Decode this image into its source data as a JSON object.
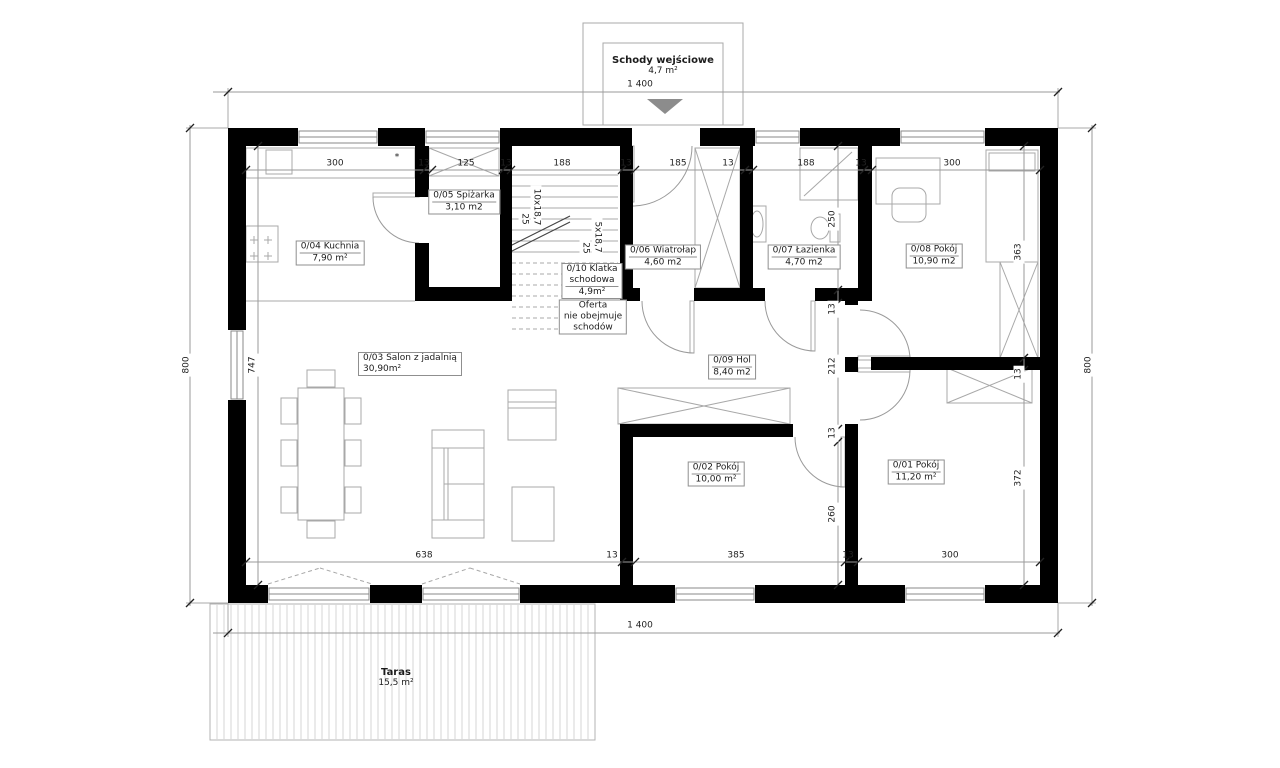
{
  "colors": {
    "wall": "#000000",
    "thin": "#9a9a9a",
    "furniture": "#a8a8a8",
    "door": "#9a9a9a",
    "hatch_line": "#d6d6d6",
    "hatch_border": "#b3b3b3",
    "tick": "#222222",
    "arrow": "#8c8c8c"
  },
  "labels": [
    {
      "n": "entrance-stairs-label",
      "lines": [
        "Schody wejściowe",
        "4,7 m²"
      ],
      "x": 663,
      "y": 66,
      "b": 1
    },
    {
      "n": "room-label-kuchnia",
      "lines": [
        "0/04 Kuchnia",
        "7,90 m²"
      ],
      "x": 330,
      "y": 253,
      "box": 1,
      "sep": 1
    },
    {
      "n": "room-label-spizarka",
      "lines": [
        "0/05 Spiżarka",
        "3,10 m2"
      ],
      "x": 464,
      "y": 202,
      "box": 1,
      "sep": 1
    },
    {
      "n": "room-label-klatka-schodowa",
      "lines": [
        "0/10 Klatka",
        "schodowa",
        "4,9m²"
      ],
      "x": 592,
      "y": 281,
      "box": 1,
      "sep": 1
    },
    {
      "n": "stairs-note",
      "lines": [
        "Oferta",
        "nie obejmuje",
        "schodów"
      ],
      "x": 593,
      "y": 317,
      "box": 1
    },
    {
      "n": "room-label-wiatrolap",
      "lines": [
        "0/06 Wiatrołap",
        "4,60 m2"
      ],
      "x": 663,
      "y": 257,
      "box": 1,
      "sep": 1
    },
    {
      "n": "room-label-lazienka",
      "lines": [
        "0/07 Łazienka",
        "4,70 m2"
      ],
      "x": 804,
      "y": 257,
      "box": 1,
      "sep": 1
    },
    {
      "n": "room-label-pokoj-08",
      "lines": [
        "0/08 Pokój",
        "10,90 m2"
      ],
      "x": 934,
      "y": 256,
      "box": 1,
      "sep": 1
    },
    {
      "n": "room-label-salon",
      "lines": [
        "0/03 Salon z jadalnią",
        "30,90m²"
      ],
      "x": 358,
      "y": 364,
      "box": 1,
      "align": "left"
    },
    {
      "n": "room-label-hol",
      "lines": [
        "0/09 Hol",
        "8,40 m2"
      ],
      "x": 732,
      "y": 367,
      "box": 1,
      "sep": 1
    },
    {
      "n": "room-label-pokoj-02",
      "lines": [
        "0/02 Pokój",
        "10,00 m²"
      ],
      "x": 716,
      "y": 474,
      "box": 1,
      "sep": 1
    },
    {
      "n": "room-label-pokoj-01",
      "lines": [
        "0/01 Pokój",
        "11,20 m²"
      ],
      "x": 916,
      "y": 472,
      "box": 1,
      "sep": 1
    },
    {
      "n": "terrace-label",
      "lines": [
        "Taras",
        "15,5 m²"
      ],
      "x": 396,
      "y": 678,
      "b": 1
    },
    {
      "n": "wall-asterisk-note",
      "lines": [
        "*"
      ],
      "x": 397,
      "y": 158
    }
  ],
  "dims": [
    {
      "v": "1 400",
      "x": 640,
      "y": 85
    },
    {
      "v": "1 400",
      "x": 640,
      "y": 626
    },
    {
      "v": "800",
      "x": 187,
      "y": 365,
      "r": -90
    },
    {
      "v": "800",
      "x": 1089,
      "y": 365,
      "r": -90
    },
    {
      "v": "300",
      "x": 335,
      "y": 164
    },
    {
      "v": "13",
      "x": 424,
      "y": 164
    },
    {
      "v": "125",
      "x": 466,
      "y": 164
    },
    {
      "v": "13",
      "x": 506,
      "y": 164
    },
    {
      "v": "188",
      "x": 562,
      "y": 164
    },
    {
      "v": "13",
      "x": 626,
      "y": 164
    },
    {
      "v": "185",
      "x": 678,
      "y": 164
    },
    {
      "v": "13",
      "x": 728,
      "y": 164
    },
    {
      "v": "188",
      "x": 806,
      "y": 164
    },
    {
      "v": "13",
      "x": 861,
      "y": 164
    },
    {
      "v": "300",
      "x": 952,
      "y": 164
    },
    {
      "v": "638",
      "x": 424,
      "y": 556
    },
    {
      "v": "13",
      "x": 612,
      "y": 556
    },
    {
      "v": "385",
      "x": 736,
      "y": 556
    },
    {
      "v": "13",
      "x": 848,
      "y": 556
    },
    {
      "v": "300",
      "x": 950,
      "y": 556
    },
    {
      "v": "747",
      "x": 253,
      "y": 365,
      "r": -90
    },
    {
      "v": "250",
      "x": 833,
      "y": 219,
      "r": -90
    },
    {
      "v": "13",
      "x": 833,
      "y": 309,
      "r": -90
    },
    {
      "v": "212",
      "x": 833,
      "y": 366,
      "r": -90
    },
    {
      "v": "13",
      "x": 833,
      "y": 433,
      "r": -90
    },
    {
      "v": "260",
      "x": 833,
      "y": 514,
      "r": -90
    },
    {
      "v": "363",
      "x": 1019,
      "y": 252,
      "r": -90
    },
    {
      "v": "13",
      "x": 1019,
      "y": 374,
      "r": -90
    },
    {
      "v": "372",
      "x": 1019,
      "y": 478,
      "r": -90
    },
    {
      "v": "10x18,7",
      "x": 536,
      "y": 207,
      "r": 90
    },
    {
      "v": "25",
      "x": 524,
      "y": 219,
      "r": 90
    },
    {
      "v": "5x18,7",
      "x": 597,
      "y": 237,
      "r": 90
    },
    {
      "v": "25",
      "x": 585,
      "y": 248,
      "r": 90
    }
  ],
  "geometry": {
    "walls": [
      [
        228,
        128,
        70,
        18
      ],
      [
        378,
        128,
        47,
        18
      ],
      [
        500,
        128,
        132,
        18
      ],
      [
        700,
        128,
        55,
        18
      ],
      [
        800,
        128,
        100,
        18
      ],
      [
        985,
        128,
        73,
        18
      ],
      [
        228,
        585,
        40,
        18
      ],
      [
        370,
        585,
        52,
        18
      ],
      [
        520,
        585,
        155,
        18
      ],
      [
        755,
        585,
        150,
        18
      ],
      [
        985,
        585,
        73,
        18
      ],
      [
        228,
        128,
        18,
        202
      ],
      [
        228,
        400,
        18,
        203
      ],
      [
        1040,
        128,
        18,
        475
      ],
      [
        415,
        146,
        14,
        51
      ],
      [
        415,
        243,
        14,
        58
      ],
      [
        415,
        287,
        91,
        14
      ],
      [
        500,
        146,
        12,
        155
      ],
      [
        620,
        146,
        13,
        155
      ],
      [
        620,
        288,
        20,
        13
      ],
      [
        694,
        288,
        46,
        13
      ],
      [
        740,
        146,
        13,
        155
      ],
      [
        740,
        288,
        25,
        13
      ],
      [
        815,
        288,
        57,
        13
      ],
      [
        858,
        146,
        14,
        155
      ],
      [
        845,
        290,
        13,
        15
      ],
      [
        845,
        357,
        13,
        15
      ],
      [
        845,
        424,
        13,
        161
      ],
      [
        620,
        424,
        173,
        13
      ],
      [
        620,
        424,
        13,
        161
      ],
      [
        871,
        357,
        169,
        13
      ]
    ],
    "windows": [
      [
        298,
        128,
        80,
        18,
        "h"
      ],
      [
        425,
        128,
        75,
        18,
        "h"
      ],
      [
        755,
        128,
        45,
        18,
        "h"
      ],
      [
        900,
        128,
        85,
        18,
        "h"
      ],
      [
        268,
        585,
        102,
        18,
        "h"
      ],
      [
        422,
        585,
        98,
        18,
        "h"
      ],
      [
        675,
        585,
        80,
        18,
        "h"
      ],
      [
        905,
        585,
        80,
        18,
        "h"
      ],
      [
        228,
        330,
        18,
        70,
        "v"
      ]
    ],
    "shapes": [
      [
        "hatch",
        210,
        604,
        385,
        136,
        7
      ],
      [
        "r",
        583,
        23,
        160,
        102
      ],
      [
        "r",
        603,
        43,
        120,
        82
      ],
      [
        "tri",
        "647,99 683,99 665,114"
      ],
      [
        "r",
        246,
        148,
        169,
        30
      ],
      [
        "r",
        266,
        150,
        26,
        24
      ],
      [
        "r",
        246,
        226,
        32,
        36
      ],
      [
        "l",
        254,
        236,
        254,
        244
      ],
      [
        "l",
        250,
        240,
        258,
        240
      ],
      [
        "l",
        268,
        236,
        268,
        244
      ],
      [
        "l",
        264,
        240,
        272,
        240
      ],
      [
        "l",
        254,
        252,
        254,
        260
      ],
      [
        "l",
        250,
        256,
        258,
        256
      ],
      [
        "l",
        268,
        252,
        268,
        260
      ],
      [
        "l",
        264,
        256,
        272,
        256
      ],
      [
        "l",
        246,
        301,
        415,
        301
      ],
      [
        "xr",
        429,
        148,
        70,
        28
      ],
      [
        "l",
        512,
        175,
        618,
        175
      ],
      [
        "l",
        512,
        186,
        618,
        186
      ],
      [
        "l",
        512,
        197,
        618,
        197
      ],
      [
        "l",
        512,
        208,
        618,
        208
      ],
      [
        "l",
        512,
        219,
        618,
        219
      ],
      [
        "l",
        512,
        230,
        618,
        230
      ],
      [
        "l",
        512,
        241,
        618,
        241
      ],
      [
        "l",
        512,
        252,
        618,
        252
      ],
      [
        "l",
        512,
        263,
        618,
        263,
        1
      ],
      [
        "l",
        512,
        274,
        618,
        274,
        1
      ],
      [
        "l",
        512,
        285,
        618,
        285,
        1
      ],
      [
        "l",
        512,
        296,
        618,
        296,
        1
      ],
      [
        "l",
        512,
        307,
        618,
        307,
        1
      ],
      [
        "l",
        512,
        318,
        618,
        318,
        1
      ],
      [
        "l",
        512,
        329,
        618,
        329,
        1
      ],
      [
        "dl",
        504,
        249,
        570,
        216
      ],
      [
        "dl",
        504,
        255,
        570,
        222
      ],
      [
        "xr",
        695,
        148,
        45,
        140
      ],
      [
        "r",
        800,
        148,
        58,
        52
      ],
      [
        "l",
        804,
        196,
        852,
        152
      ],
      [
        "r",
        748,
        206,
        18,
        36
      ],
      [
        "el",
        757,
        224,
        6,
        13
      ],
      [
        "r",
        830,
        214,
        10,
        28
      ],
      [
        "el",
        820,
        228,
        9,
        11
      ],
      [
        "r",
        876,
        158,
        64,
        46
      ],
      [
        "rr",
        892,
        188,
        34,
        34,
        8
      ],
      [
        "r",
        986,
        150,
        52,
        112
      ],
      [
        "r",
        989,
        153,
        46,
        18
      ],
      [
        "xr",
        1000,
        262,
        38,
        96
      ],
      [
        "xr",
        947,
        368,
        85,
        35
      ],
      [
        "xr",
        618,
        388,
        172,
        36
      ],
      [
        "r",
        298,
        388,
        46,
        132
      ],
      [
        "r",
        281,
        398,
        16,
        26
      ],
      [
        "r",
        281,
        440,
        16,
        26
      ],
      [
        "r",
        281,
        487,
        16,
        26
      ],
      [
        "r",
        345,
        398,
        16,
        26
      ],
      [
        "r",
        345,
        440,
        16,
        26
      ],
      [
        "r",
        345,
        487,
        16,
        26
      ],
      [
        "r",
        307,
        370,
        28,
        17
      ],
      [
        "r",
        307,
        521,
        28,
        17
      ],
      [
        "r",
        432,
        430,
        52,
        108
      ],
      [
        "l",
        444,
        448,
        444,
        520
      ],
      [
        "l",
        448,
        448,
        448,
        520
      ],
      [
        "l",
        444,
        484,
        484,
        484
      ],
      [
        "l",
        432,
        448,
        484,
        448
      ],
      [
        "l",
        432,
        520,
        484,
        520
      ],
      [
        "r",
        508,
        390,
        48,
        50
      ],
      [
        "l",
        508,
        402,
        556,
        402
      ],
      [
        "l",
        508,
        408,
        556,
        408
      ],
      [
        "r",
        512,
        487,
        42,
        54
      ],
      [
        "r",
        373,
        193,
        46,
        4
      ],
      [
        "arc",
        419,
        197,
        46,
        90,
        180
      ],
      [
        "r",
        630,
        146,
        4,
        56
      ],
      [
        "arc",
        632,
        146,
        60,
        0,
        90
      ],
      [
        "r",
        690,
        301,
        4,
        52
      ],
      [
        "arc",
        694,
        301,
        52,
        90,
        180
      ],
      [
        "r",
        811,
        301,
        4,
        50
      ],
      [
        "arc",
        815,
        301,
        50,
        90,
        180
      ],
      [
        "r",
        858,
        356,
        52,
        4
      ],
      [
        "arc",
        860,
        360,
        50,
        270,
        360
      ],
      [
        "r",
        858,
        368,
        52,
        4
      ],
      [
        "arc",
        860,
        370,
        50,
        0,
        90
      ],
      [
        "r",
        841,
        437,
        4,
        50
      ],
      [
        "arc",
        845,
        437,
        50,
        90,
        180
      ],
      [
        "l",
        268,
        584,
        320,
        568,
        1
      ],
      [
        "l",
        320,
        568,
        372,
        584,
        1
      ],
      [
        "l",
        422,
        584,
        470,
        568,
        1
      ],
      [
        "l",
        470,
        568,
        520,
        584,
        1
      ],
      [
        "l",
        228,
        128,
        228,
        88
      ],
      [
        "l",
        1058,
        128,
        1058,
        88
      ],
      [
        "l",
        228,
        603,
        228,
        637
      ],
      [
        "l",
        1058,
        603,
        1058,
        637
      ],
      [
        "l",
        228,
        128,
        186,
        128
      ],
      [
        "l",
        228,
        603,
        186,
        603
      ],
      [
        "l",
        1058,
        128,
        1096,
        128
      ],
      [
        "l",
        1058,
        603,
        1096,
        603
      ]
    ],
    "dimlines": [
      {
        "x1": 213,
        "y1": 92,
        "x2": 1060,
        "y2": 92,
        "t": [
          [
            228,
            92
          ],
          [
            1058,
            92
          ]
        ]
      },
      {
        "x1": 213,
        "y1": 633,
        "x2": 1060,
        "y2": 633,
        "t": [
          [
            228,
            633
          ],
          [
            1058,
            633
          ]
        ]
      },
      {
        "x1": 190,
        "y1": 125,
        "x2": 190,
        "y2": 606,
        "t": [
          [
            190,
            128
          ],
          [
            190,
            603
          ]
        ]
      },
      {
        "x1": 1092,
        "y1": 125,
        "x2": 1092,
        "y2": 606,
        "t": [
          [
            1092,
            128
          ],
          [
            1092,
            603
          ]
        ]
      },
      {
        "x1": 246,
        "y1": 170,
        "x2": 1040,
        "y2": 170,
        "t": [
          [
            246,
            170
          ],
          [
            424,
            170
          ],
          [
            432,
            170
          ],
          [
            503,
            170
          ],
          [
            511,
            170
          ],
          [
            622,
            170
          ],
          [
            635,
            170
          ],
          [
            745,
            170
          ],
          [
            753,
            170
          ],
          [
            864,
            170
          ],
          [
            872,
            170
          ],
          [
            1040,
            170
          ]
        ]
      },
      {
        "x1": 246,
        "y1": 562,
        "x2": 1040,
        "y2": 562,
        "t": [
          [
            246,
            562
          ],
          [
            622,
            562
          ],
          [
            635,
            562
          ],
          [
            845,
            562
          ],
          [
            858,
            562
          ],
          [
            1040,
            562
          ]
        ]
      },
      {
        "x1": 258,
        "y1": 146,
        "x2": 258,
        "y2": 585,
        "t": [
          [
            258,
            146
          ],
          [
            258,
            585
          ]
        ]
      },
      {
        "x1": 838,
        "y1": 146,
        "x2": 838,
        "y2": 585,
        "t": [
          [
            838,
            146
          ],
          [
            838,
            290
          ],
          [
            838,
            303
          ],
          [
            838,
            429
          ],
          [
            838,
            442
          ],
          [
            838,
            585
          ]
        ]
      },
      {
        "x1": 1024,
        "y1": 146,
        "x2": 1024,
        "y2": 585,
        "t": [
          [
            1024,
            146
          ],
          [
            1024,
            358
          ],
          [
            1024,
            370
          ],
          [
            1024,
            585
          ]
        ]
      }
    ]
  }
}
